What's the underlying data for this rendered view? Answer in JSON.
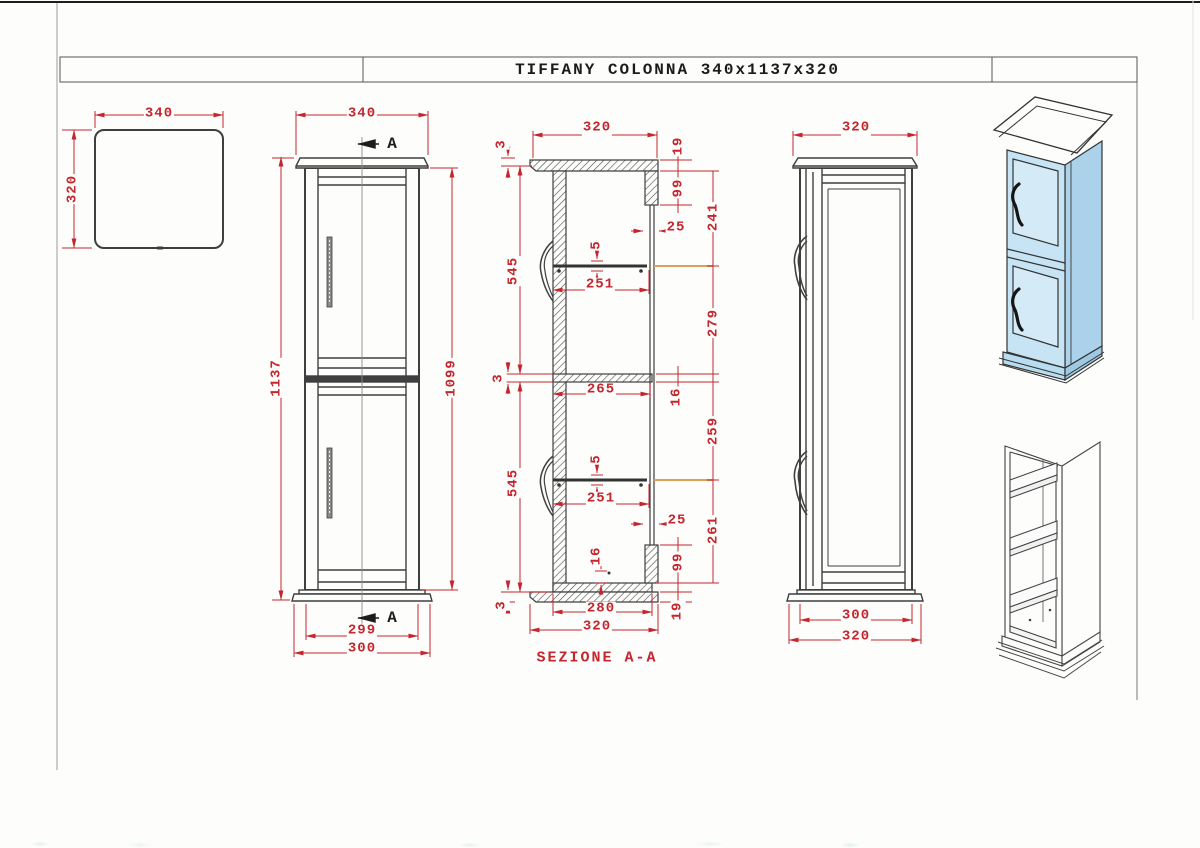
{
  "title_block": {
    "title": "TIFFANY COLONNA 340x1137x320"
  },
  "top_view": {
    "width": "340",
    "depth": "320"
  },
  "front_view": {
    "width": "340",
    "section_marker_top": "A",
    "section_marker_bottom": "A",
    "height_total": "1137",
    "height_carcass": "1099",
    "width_door": "299",
    "width_base": "300"
  },
  "section_view": {
    "label": "SEZIONE A-A",
    "depth_top": "320",
    "lip_top": "3",
    "top_thickness": "19",
    "back_rail_top_height": "99",
    "back_rail_width_top": "25",
    "opening_top": "241",
    "door_height_top": "545",
    "shelf_thickness_top": "5",
    "shelf_depth_top": "251",
    "shelf_to_divider": "279",
    "lip_mid": "3",
    "divider_depth": "265",
    "divider_thickness": "16",
    "divider_to_shelf": "259",
    "door_height_bottom": "545",
    "shelf_thickness_bottom": "5",
    "shelf_depth_bottom": "251",
    "back_rail_width_bottom": "25",
    "shelf_to_bottom": "261",
    "bottom_offset": "16",
    "back_rail_bottom_height": "99",
    "lip_bottom": "3",
    "bottom_inner_depth": "280",
    "depth_bottom": "320",
    "bottom_thickness": "19"
  },
  "side_view": {
    "depth_top": "320",
    "depth_body": "300",
    "depth_base": "320"
  },
  "colors": {
    "dimension_red": "#c4262e",
    "line_dark": "#3f3f3f",
    "accent_orange": "#dfa05a",
    "iso_front_blue": "#c6e4f4",
    "iso_side_blue": "#abd2ea"
  }
}
